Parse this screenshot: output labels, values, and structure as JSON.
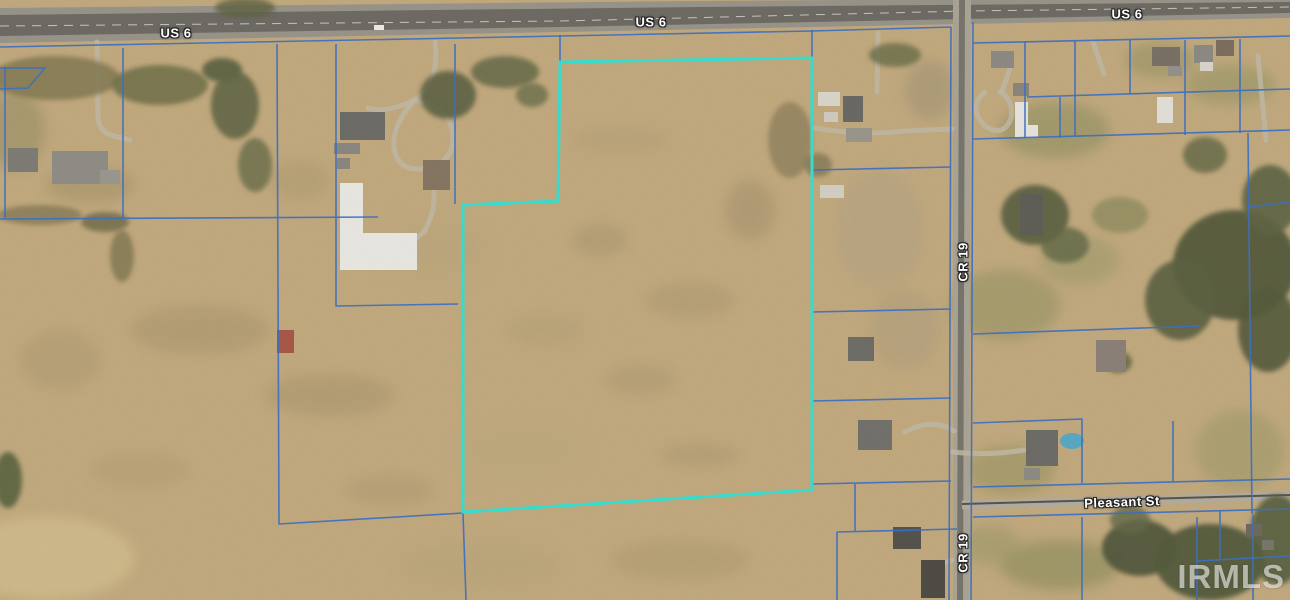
{
  "map": {
    "size": {
      "w": 1290,
      "h": 600
    },
    "colors": {
      "base": "#c2a97e",
      "road_shoulder": "#98948a",
      "asphalt": "#6e6b64",
      "road_line": "#dedcd4",
      "cr19_surface": "#aaa496",
      "cr19_stripe": "#78756c",
      "pleasant_surface": "#b2ac9e",
      "pleasant_dark": "#57544c",
      "driveway": "#c0b8a4",
      "parcel_line": "#3d6fc0",
      "subject": "#35dcce",
      "label_text": "#ffffff",
      "watermark": "#e2e2de"
    },
    "road_labels": [
      {
        "text": "US 6",
        "x": 176,
        "y": 33,
        "rot": 0
      },
      {
        "text": "US 6",
        "x": 651,
        "y": 22,
        "rot": 0
      },
      {
        "text": "US 6",
        "x": 1127,
        "y": 14,
        "rot": 0
      },
      {
        "text": "CR 19",
        "x": 963,
        "y": 262,
        "rot": -90
      },
      {
        "text": "CR 19",
        "x": 963,
        "y": 553,
        "rot": -90
      },
      {
        "text": "Pleasant St",
        "x": 1122,
        "y": 502,
        "rot": -2
      }
    ],
    "watermark": {
      "text": "IRMLS"
    },
    "subject_parcel": {
      "points": "560,62 812,58 812,490 463,512 463,205 558,201"
    },
    "roads": {
      "us6_shoulder": "0,8 700,1 1290,-3 1290,18 965,24 560,32 0,43",
      "us6_asphalt": "0,15 700,7 1290,2 1290,13 965,19 560,27 0,36",
      "us6_center": "0,26 560,21 965,11 1290,7",
      "cr19": "953,0 971,0 969,600 953,600",
      "cr19_stripe": "959,0 965,0 963,600 957,600",
      "pleasant": [
        962,
        505,
        1290,
        496
      ]
    },
    "parcel_lines": [
      "0,47 560,36 812,31 951,27",
      "973,43 1290,36",
      "5,67 5,218",
      "0,68 45,68 28,88 0,89",
      "123,48 123,218",
      "0,219 378,217",
      "277,44 279,524 463,513 466,600",
      "336,44 336,306 458,304",
      "455,44 455,204",
      "560,35 560,62",
      "812,30 812,57",
      "812,170 951,167",
      "812,312 951,309",
      "812,401 951,398",
      "812,484 951,481",
      "855,484 855,531",
      "837,600 837,532 957,529",
      "951,27 949,600",
      "973,22 971,600",
      "1025,42 1025,138",
      "1075,41 1075,136",
      "1130,40 1130,94",
      "1185,40 1185,135",
      "1240,39 1240,133",
      "1027,97 1290,89",
      "973,139 1290,130",
      "1060,97 1060,138",
      "1248,133 1252,514",
      "1248,207 1290,202",
      "973,334 1200,326",
      "973,423 1082,419 1082,483",
      "973,487 1290,479",
      "973,517 1290,509",
      "1173,421 1173,481",
      "1082,517 1082,600",
      "1197,517 1197,600",
      "1197,561 1290,556",
      "1220,511 1220,560",
      "1253,515 1253,600"
    ],
    "patches": [
      [
        15,
        130,
        30,
        40,
        "#9a8f66",
        0.6
      ],
      [
        90,
        185,
        45,
        18,
        "#a39168",
        0.5
      ],
      [
        200,
        330,
        70,
        25,
        "#a8956e",
        0.5
      ],
      [
        330,
        395,
        65,
        22,
        "#a8956e",
        0.5
      ],
      [
        140,
        470,
        50,
        18,
        "#b09c72",
        0.45
      ],
      [
        390,
        490,
        45,
        15,
        "#a8956e",
        0.4
      ],
      [
        60,
        360,
        40,
        30,
        "#ab9870",
        0.45
      ],
      [
        45,
        558,
        90,
        42,
        "#d2bf8e",
        0.75
      ],
      [
        480,
        565,
        80,
        25,
        "#b7a47a",
        0.5
      ],
      [
        680,
        560,
        70,
        20,
        "#ad9a70",
        0.5
      ],
      [
        600,
        240,
        28,
        16,
        "#a5946f",
        0.45
      ],
      [
        690,
        300,
        45,
        18,
        "#a5946f",
        0.4
      ],
      [
        640,
        380,
        35,
        15,
        "#a5946f",
        0.4
      ],
      [
        750,
        210,
        25,
        30,
        "#9e8e6a",
        0.45
      ],
      [
        620,
        140,
        50,
        15,
        "#b4a078",
        0.5
      ],
      [
        700,
        455,
        40,
        12,
        "#a5946f",
        0.4
      ],
      [
        545,
        330,
        40,
        18,
        "#b2a077",
        0.45
      ],
      [
        880,
        230,
        45,
        60,
        "#b1a384",
        0.5
      ],
      [
        905,
        330,
        35,
        40,
        "#aa9c7d",
        0.45
      ],
      [
        930,
        90,
        25,
        30,
        "#9e9274",
        0.5
      ],
      [
        1055,
        130,
        55,
        28,
        "#8f9163",
        0.6
      ],
      [
        1230,
        85,
        45,
        20,
        "#949565",
        0.55
      ],
      [
        1005,
        305,
        55,
        35,
        "#8d9060",
        0.5
      ],
      [
        1080,
        260,
        40,
        25,
        "#9a9a6a",
        0.5
      ],
      [
        1060,
        565,
        60,
        25,
        "#8b8d5c",
        0.6
      ],
      [
        990,
        545,
        30,
        20,
        "#979767",
        0.5
      ],
      [
        1160,
        60,
        35,
        18,
        "#8e9062",
        0.5
      ],
      [
        1010,
        470,
        45,
        25,
        "#91925f",
        0.5
      ],
      [
        1240,
        450,
        45,
        40,
        "#9a9868",
        0.5
      ],
      [
        430,
        250,
        60,
        30,
        "#b9a77d",
        0.5
      ],
      [
        520,
        450,
        70,
        30,
        "#baa87d",
        0.4
      ],
      [
        300,
        180,
        30,
        20,
        "#ad9a70",
        0.5
      ]
    ],
    "trees": [
      [
        55,
        78,
        65,
        22,
        "#877d55",
        0.9
      ],
      [
        160,
        85,
        48,
        20,
        "#6f6f4a",
        0.85
      ],
      [
        222,
        70,
        20,
        12,
        "#5c6242",
        0.9
      ],
      [
        235,
        105,
        24,
        34,
        "#636746",
        0.9
      ],
      [
        255,
        165,
        17,
        27,
        "#6b6e4b",
        0.8
      ],
      [
        105,
        222,
        24,
        10,
        "#6f6a48",
        0.8
      ],
      [
        122,
        256,
        12,
        26,
        "#77714e",
        0.7
      ],
      [
        40,
        215,
        42,
        10,
        "#7d7451",
        0.7
      ],
      [
        448,
        95,
        28,
        24,
        "#5f6444",
        0.9
      ],
      [
        505,
        72,
        34,
        16,
        "#666a48",
        0.85
      ],
      [
        532,
        95,
        16,
        12,
        "#6b6f4c",
        0.8
      ],
      [
        245,
        8,
        30,
        10,
        "#5e6342",
        0.8
      ],
      [
        895,
        55,
        26,
        12,
        "#6a6e4a",
        0.8
      ],
      [
        790,
        140,
        22,
        38,
        "#8d7f5c",
        0.75
      ],
      [
        818,
        165,
        14,
        12,
        "#7a7451",
        0.7
      ],
      [
        1035,
        215,
        34,
        30,
        "#5a6040",
        0.9
      ],
      [
        1065,
        245,
        24,
        18,
        "#636947",
        0.8
      ],
      [
        1205,
        155,
        22,
        18,
        "#636947",
        0.8
      ],
      [
        1235,
        265,
        62,
        55,
        "#565c3e",
        0.95
      ],
      [
        1180,
        300,
        35,
        40,
        "#5c6242",
        0.9
      ],
      [
        1270,
        200,
        28,
        35,
        "#5f6544",
        0.9
      ],
      [
        1268,
        330,
        30,
        42,
        "#565c3e",
        0.9
      ],
      [
        1120,
        215,
        28,
        18,
        "#7e8455",
        0.6
      ],
      [
        1140,
        548,
        38,
        28,
        "#4f553b",
        0.9
      ],
      [
        1210,
        562,
        55,
        38,
        "#555b3e",
        0.95
      ],
      [
        1277,
        540,
        28,
        45,
        "#596040",
        0.9
      ],
      [
        1130,
        520,
        20,
        14,
        "#646a48",
        0.8
      ],
      [
        8,
        480,
        14,
        28,
        "#55603c",
        0.85
      ],
      [
        1118,
        362,
        14,
        11,
        "#5f6544",
        0.8
      ]
    ],
    "driveways": [
      "M97,42 L98,118 Q99,132 114,136 L130,140",
      "M435,42 Q440,85 415,100 Q385,114 368,108",
      "M415,100 Q452,108 453,136 Q454,162 428,168 Q398,174 394,148 Q392,124 415,100",
      "M428,168 Q442,200 424,232 L396,254",
      "M878,33 L877,92",
      "M815,128 Q860,136 905,131 L952,129",
      "M1012,62 L1002,92",
      "M985,92 Q967,108 985,126 Q1004,138 1011,118 Q1014,100 1000,92",
      "M1093,42 L1104,74",
      "M1258,56 L1266,140",
      "M952,452 Q988,456 1024,450",
      "M905,432 Q932,417 954,431",
      "M952,560 Q935,565 928,580"
    ],
    "buildings": [
      [
        8,
        148,
        30,
        24,
        "#7e7c75"
      ],
      [
        52,
        151,
        56,
        33,
        "#8f8d86"
      ],
      [
        100,
        170,
        20,
        14,
        "#9a978f"
      ],
      [
        340,
        112,
        45,
        28,
        "#6e6c66"
      ],
      [
        334,
        143,
        26,
        11,
        "#8a8781"
      ],
      [
        337,
        158,
        13,
        11,
        "#8a8781"
      ],
      [
        423,
        160,
        27,
        30,
        "#857663"
      ],
      [
        277,
        330,
        17,
        23,
        "#a85848"
      ],
      [
        374,
        25,
        10,
        5,
        "#eceae4"
      ],
      [
        818,
        92,
        22,
        14,
        "#d9d5cb"
      ],
      [
        843,
        96,
        20,
        26,
        "#6b6965"
      ],
      [
        824,
        112,
        14,
        10,
        "#cfcbc1"
      ],
      [
        846,
        128,
        26,
        14,
        "#9a968c"
      ],
      [
        820,
        185,
        24,
        13,
        "#d3cfc5"
      ],
      [
        848,
        337,
        26,
        24,
        "#6f6d67"
      ],
      [
        858,
        420,
        34,
        30,
        "#73716b"
      ],
      [
        893,
        527,
        28,
        22,
        "#55534c"
      ],
      [
        921,
        560,
        24,
        38,
        "#4e4c45"
      ],
      [
        991,
        51,
        23,
        17,
        "#8c8a82"
      ],
      [
        1013,
        83,
        16,
        13,
        "#8a867c"
      ],
      [
        1152,
        47,
        28,
        19,
        "#7a7165"
      ],
      [
        1168,
        66,
        14,
        10,
        "#95918a"
      ],
      [
        1194,
        45,
        19,
        18,
        "#8c8a82"
      ],
      [
        1200,
        62,
        13,
        9,
        "#d9d5cb"
      ],
      [
        1216,
        40,
        18,
        16,
        "#7d6f5f"
      ],
      [
        1157,
        97,
        16,
        26,
        "#e2dfd8"
      ],
      [
        1020,
        194,
        23,
        42,
        "#5f5e57"
      ],
      [
        1096,
        340,
        30,
        32,
        "#8b8178"
      ],
      [
        1026,
        430,
        32,
        36,
        "#6e6c66"
      ],
      [
        1024,
        468,
        16,
        12,
        "#8e8b84"
      ],
      [
        1246,
        524,
        16,
        12,
        "#6e6a60"
      ],
      [
        1262,
        540,
        12,
        10,
        "#7a766c"
      ]
    ],
    "building_polys": [
      {
        "points": "340,183 363,183 363,233 417,233 417,270 340,270",
        "color": "#e9e7e1"
      },
      {
        "points": "1015,102 1028,102 1028,125 1038,125 1038,138 1015,138",
        "color": "#e6e4de"
      }
    ],
    "pool": [
      1072,
      441,
      12,
      8,
      "#5aa8c4"
    ]
  }
}
